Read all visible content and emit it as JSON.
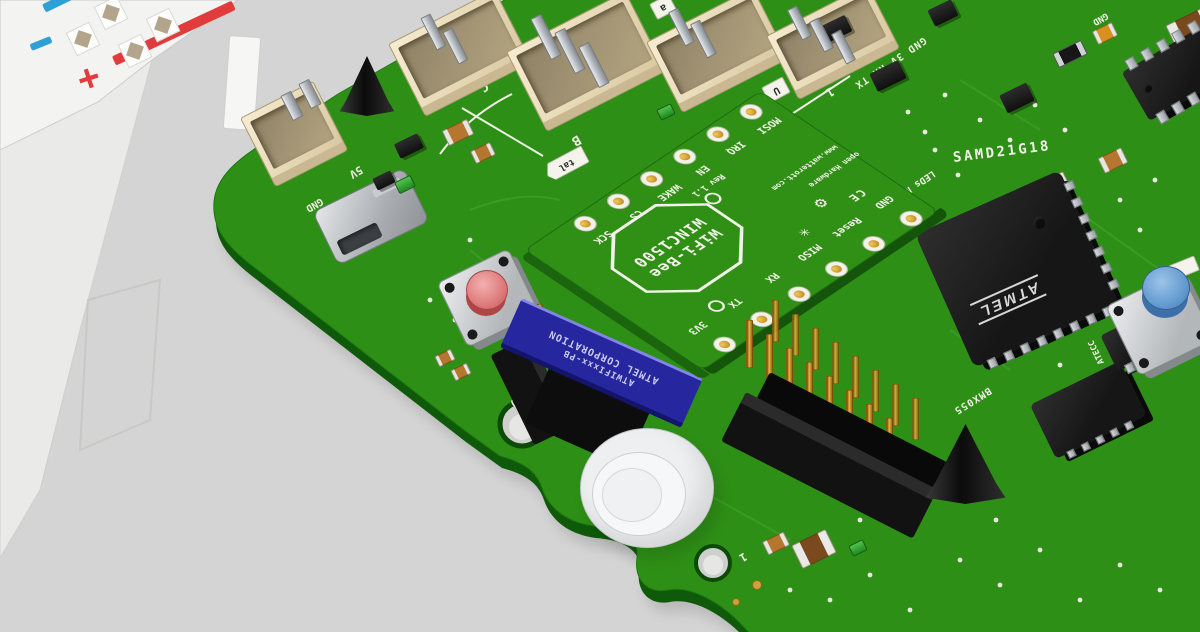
{
  "colors": {
    "pcb_green": "#2f9015",
    "board_green": "#2e8f16",
    "module_blue": "#26279e",
    "button_red_cap": "#e89c9c",
    "button_blue_cap": "#6fa8dc",
    "gold": "#d89c28",
    "silk_white": "#f0f1e6",
    "connector_beige": "#e9dcba",
    "rail_red": "#e23b3b",
    "rail_blue": "#2f9fd8"
  },
  "breadboard": {
    "plus_label": "+",
    "minus_label": "−"
  },
  "wifi_module": {
    "title_line1": "WiFi-Bee",
    "title_line2": "WINC1500",
    "revision": "Rev 1.1",
    "website": "www.watterott.com",
    "open_hardware": "open Hardware",
    "ce_mark": "CE",
    "gear_icon": "⚙",
    "star_icon": "✳",
    "top_pins": [
      "SCK",
      "CS",
      "WAKE",
      "EN",
      "IRQ",
      "MOSI"
    ],
    "bottom_pins": [
      "3V3",
      "TX",
      "RX",
      "MISO",
      "Reset",
      "GND"
    ]
  },
  "atmel_module": {
    "line1": "ATMEL CORPORATION",
    "line2": "ATWIFIxxx-PB"
  },
  "board_silk": {
    "mcu": "SAMD21G18",
    "mcu_logo": "ATMEL",
    "imu": "BMX055",
    "crypto": "ATECC",
    "uart_pins": "GND 3V RX TX",
    "led_row1": "LEDs NET WIFI",
    "led_row2": "GND ERR",
    "power_5v": "5V",
    "power_gnd": "GND",
    "gnd_top": "GND",
    "hole_label": "20",
    "pin1_bottom": "1",
    "port_1": "1",
    "port_2": "2",
    "port_a": "a",
    "port_b": "B",
    "port_c": "C",
    "port_u": "U",
    "xtal": "tal"
  }
}
